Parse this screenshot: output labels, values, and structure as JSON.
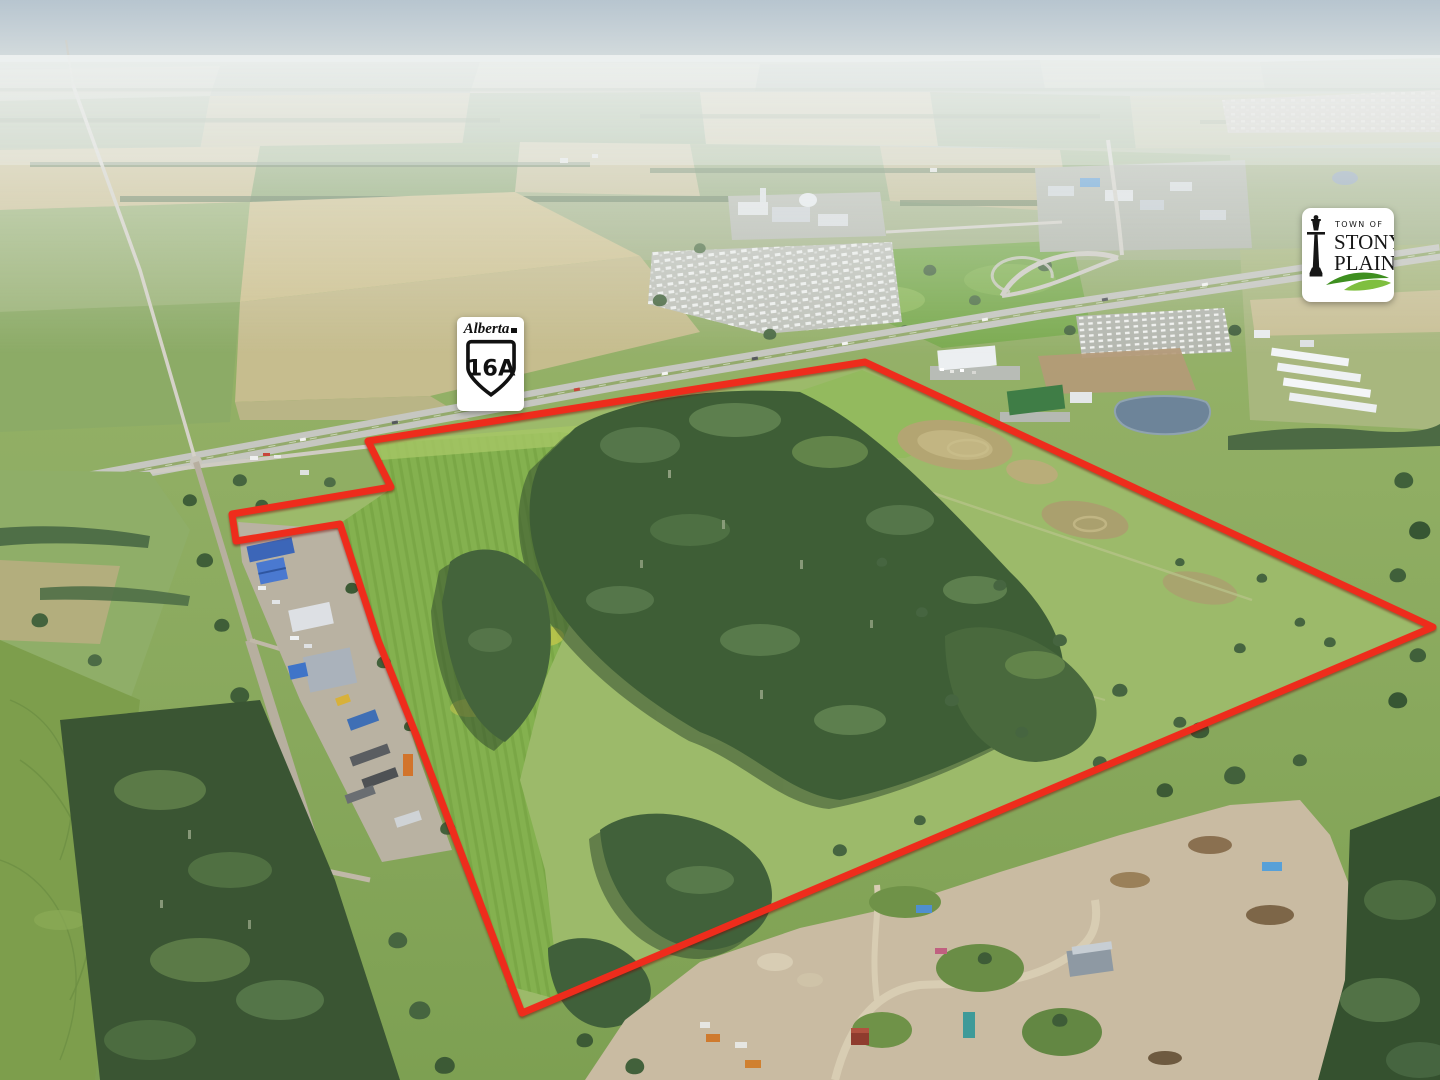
{
  "boundary": {
    "color": "#ee2c1c",
    "stroke_width": 7,
    "points": [
      [
        865,
        362
      ],
      [
        1433,
        627
      ],
      [
        522,
        1013
      ],
      [
        417,
        737
      ],
      [
        378,
        640
      ],
      [
        340,
        524
      ],
      [
        236,
        541
      ],
      [
        232,
        514
      ],
      [
        391,
        487
      ],
      [
        368,
        441
      ]
    ],
    "points_attr": "865,362 1433,627 522,1013 417,737 378,640 340,524 236,541 232,514 391,487 368,441"
  },
  "highway_shield": {
    "province": "Alberta",
    "route": "16A"
  },
  "town_logo": {
    "line_top": "TOWN OF",
    "line_name_1": "STONY",
    "line_name_2": "PLAIN",
    "green_dark": "#3e8f1f",
    "green_light": "#7fbf3f"
  },
  "palette": {
    "sky_haze": "#c3cfd6",
    "crop_field_green": "#85b14f",
    "meadow_green": "#9cba6a",
    "forest_green": "#3e5e36",
    "distant_tan": "#cdc295",
    "highway_gray": "#c6c7c1",
    "gravel_road_tan": "#b7af9f",
    "dirt_yard_tan": "#c9bba2",
    "water_blue": "#6d8499"
  }
}
